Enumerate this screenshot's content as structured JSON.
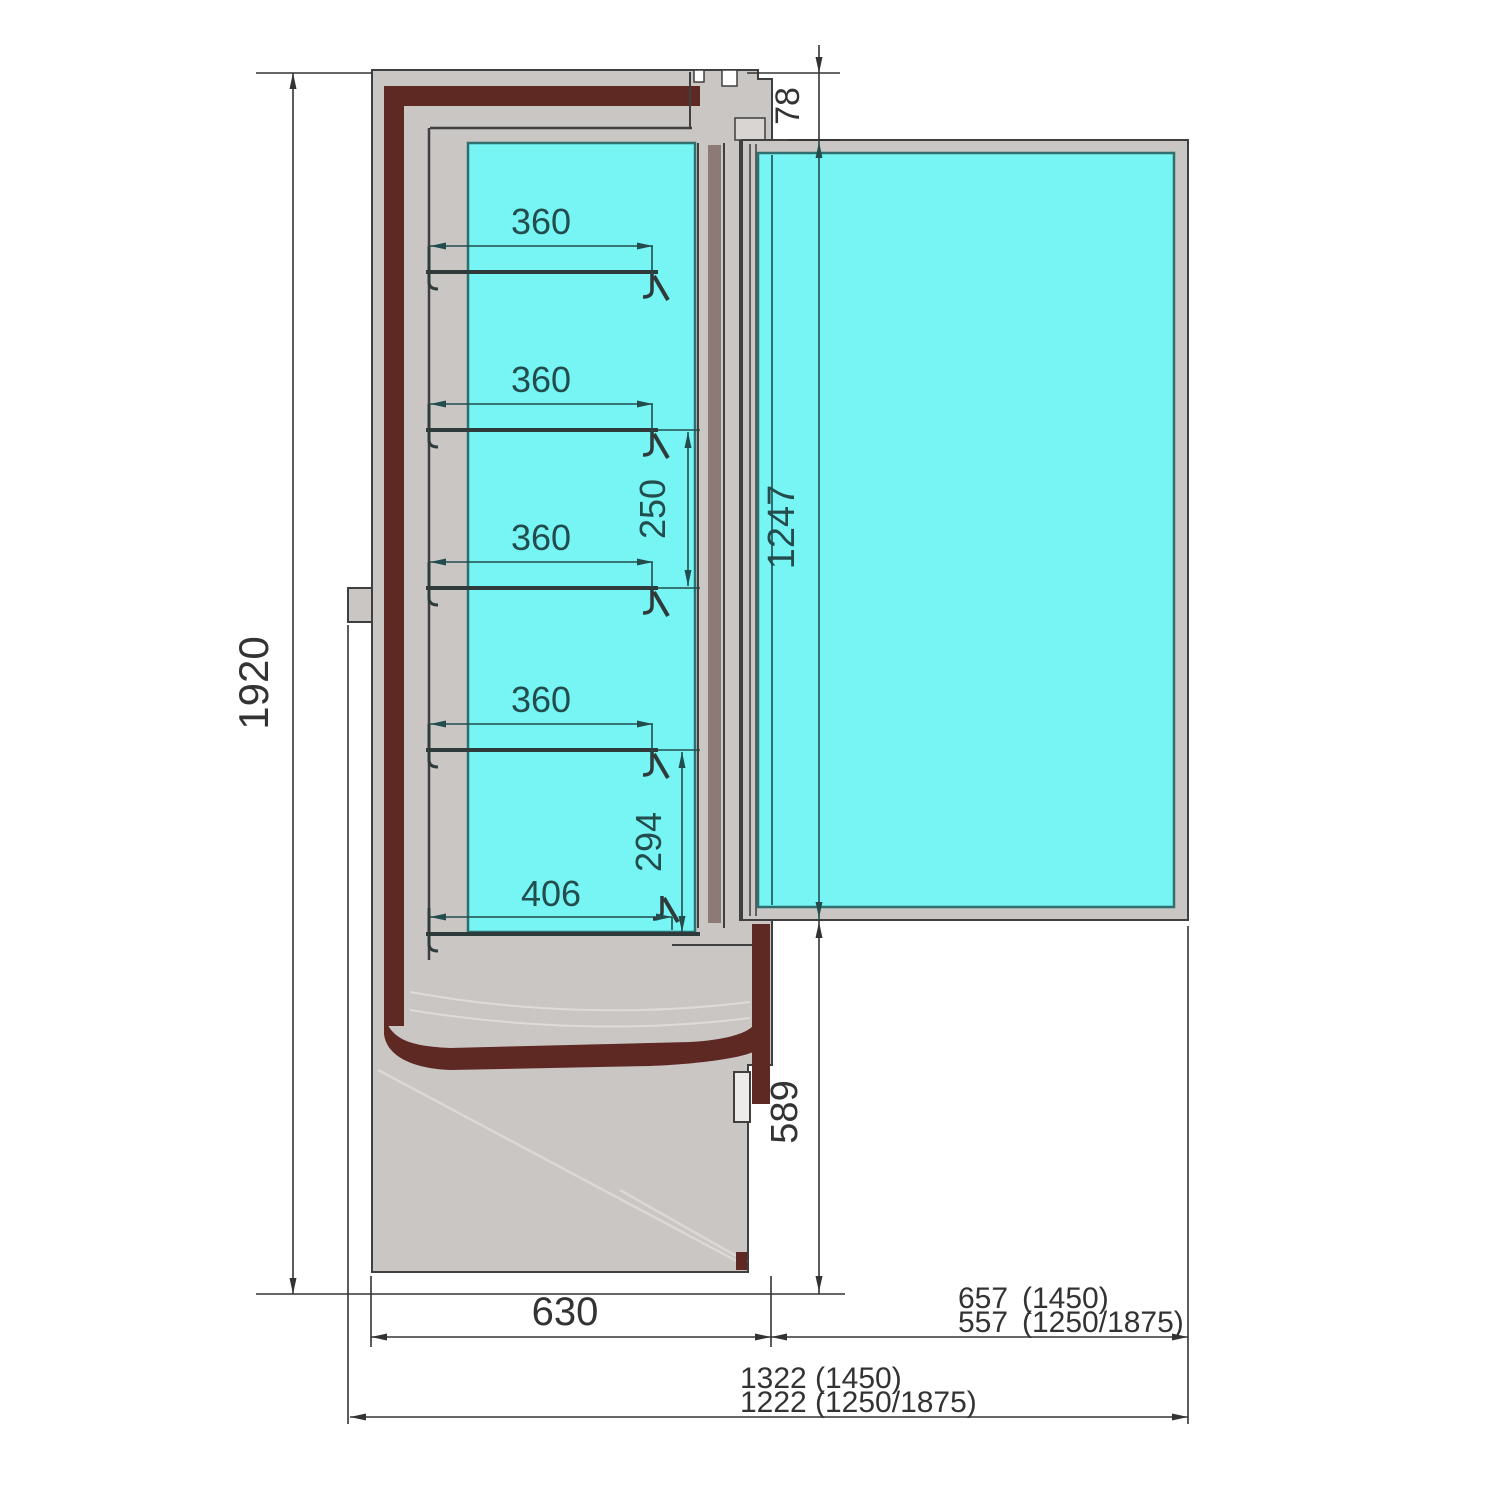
{
  "drawing": {
    "title": "Refrigerated wall cabinet - side cross-section",
    "units": "mm",
    "colors": {
      "glass_cyan": "#77F4F4",
      "body_gray": "#C9C6C3",
      "liner_maroon": "#5E2823",
      "outline_dark": "#3F3F3F",
      "dim_primary": "#333333",
      "dim_teal": "#234C4C",
      "background": "#FFFFFF"
    },
    "dimensions": {
      "overall_height": "1920",
      "top_clearance": "78",
      "door_height": "1247",
      "lower_front_height": "589",
      "cabinet_depth": "630",
      "shelf_depth_1": "360",
      "shelf_depth_2": "360",
      "shelf_depth_3": "360",
      "shelf_depth_4": "360",
      "shelf_pitch_mid": "250",
      "shelf_pitch_bottom": "294",
      "bottom_shelf_depth": "406",
      "door_swing_depth": {
        "value_1450": "657",
        "note_1450": "(1450)",
        "value_other": "557",
        "note_other": "(1250/1875)"
      },
      "overall_depth": {
        "value_1450": "1322",
        "note_1450": "(1450)",
        "value_other": "1222",
        "note_other": "(1250/1875)"
      }
    }
  }
}
